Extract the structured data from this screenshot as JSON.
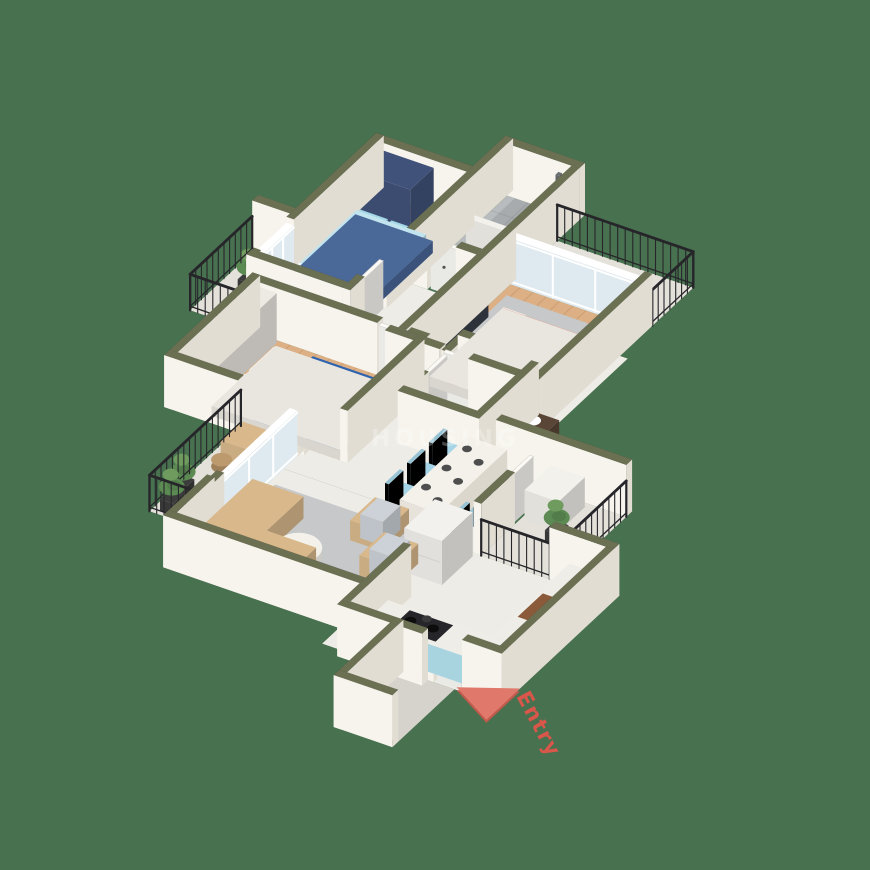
{
  "background_color": "#48714f",
  "watermark": {
    "text": "HOUSING",
    "color": "#ffffff",
    "opacity": 0.27
  },
  "entry_marker": {
    "label": "Entry",
    "arrow_color": "#e0796b",
    "arrow_shadow": "#bf5a4d",
    "label_color": "#d9564a"
  },
  "palette": {
    "wall_top": "#6c7053",
    "wall_light": "#f7f4ed",
    "wall_shade": "#e1ddd3",
    "floor_wood": "#dcb084",
    "floor_tile": "#b9bcbe",
    "floor_marble": "#eeece6",
    "floor_balcony": "#e4e1da",
    "floor_lobby": "#d6d3cd",
    "rug": "#c6c8ca",
    "railing": "#26262a",
    "glass": "#dfeaf0",
    "door": "#fbfaf6",
    "bed_master_frame": "#4a6898",
    "bed_master_sheet": "#c2e4ee",
    "bed_master_pillow": "#a3d7e6",
    "wardrobe_navy": "#41527a",
    "bed_blue": "#2f63ae",
    "bed_orange": "#e18a6d",
    "bed_orange_pillow": "#e9957a",
    "sofa_tan": "#d9b98c",
    "cushion_gray": "#c3c9d2",
    "chair_blue": "#a5d4e6",
    "counter_blue": "#a8d4e0",
    "counter_top": "#efede7",
    "stove_black": "#26262a",
    "sink_brown": "#8a5a3a",
    "white": "#f2f1ec",
    "dark": "#3a3f48",
    "plant_green": "#5b8a52",
    "plant_green_light": "#6f9b5e",
    "pot_dark": "#3c3c3c",
    "wood_dark": "#5a4636"
  }
}
